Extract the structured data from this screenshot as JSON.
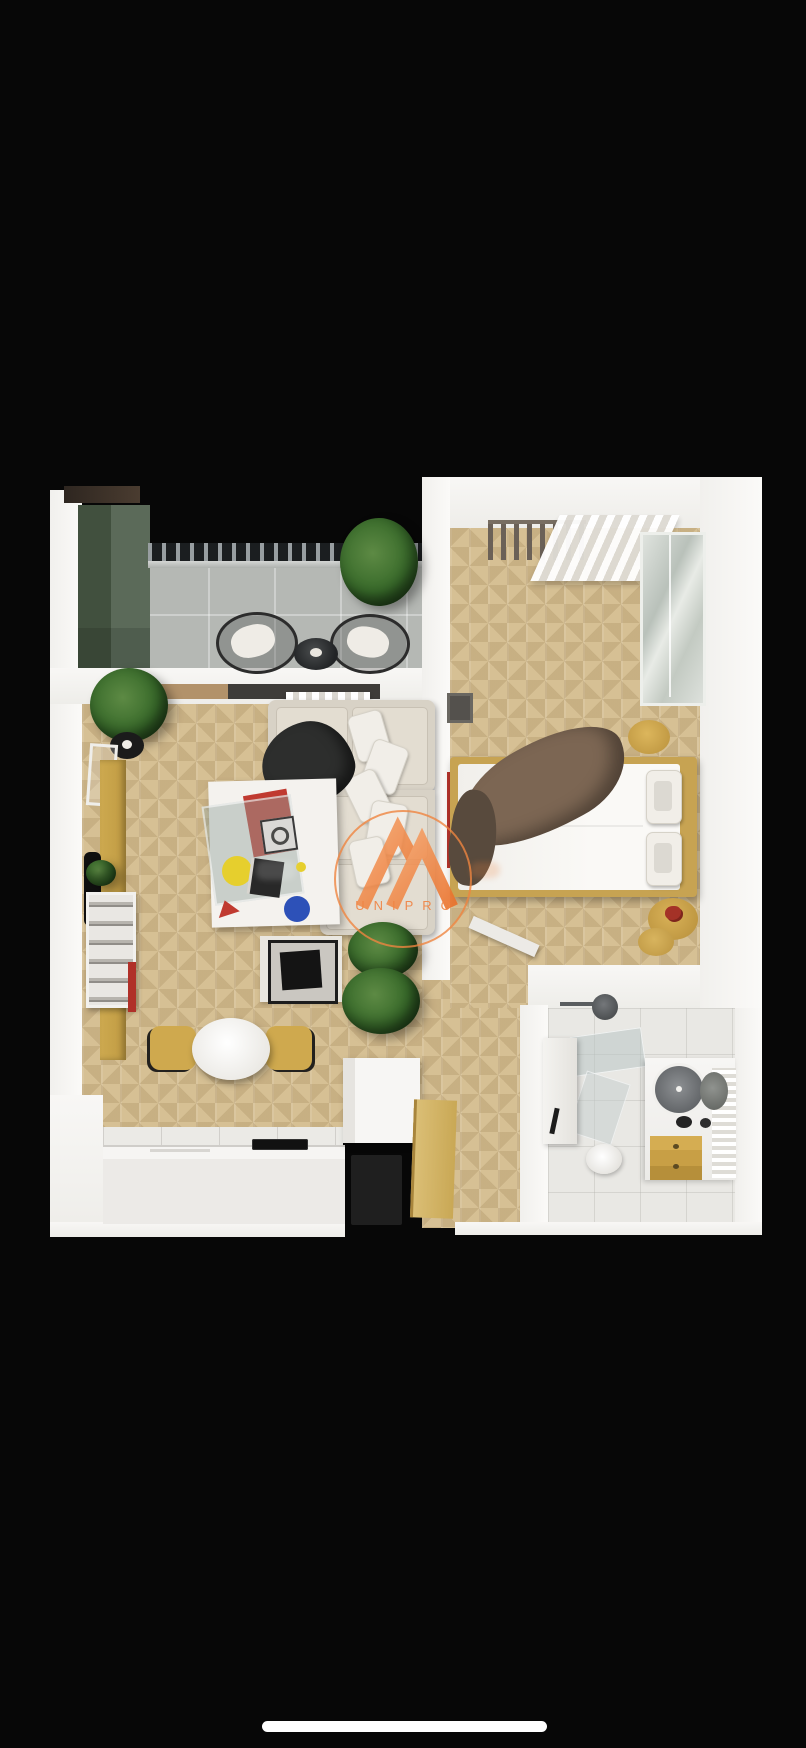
{
  "screen": {
    "background": "#070707"
  },
  "watermark": {
    "brand": "UNIPRO",
    "accent_color": "#ef8440"
  },
  "scene": {
    "type": "3d-floor-plan-render",
    "rooms": [
      "balcony",
      "living-room",
      "bedroom",
      "bathroom",
      "kitchen",
      "hallway"
    ],
    "colors": {
      "wall_white": "#f7f6f4",
      "wood_floor": "#d6c094",
      "balcony_tile": "#b5b8b4",
      "bathroom_tile": "#e9e8e4",
      "cabinet_green": "#52614f",
      "accent_gold": "#c7a14e",
      "accent_red": "#b8352c",
      "accent_blue": "#2d51b8",
      "accent_yellow": "#e6cf2d",
      "plant_green": "#3c6b2e",
      "watermark_orange": "#ef8440",
      "background_black": "#070707"
    }
  }
}
